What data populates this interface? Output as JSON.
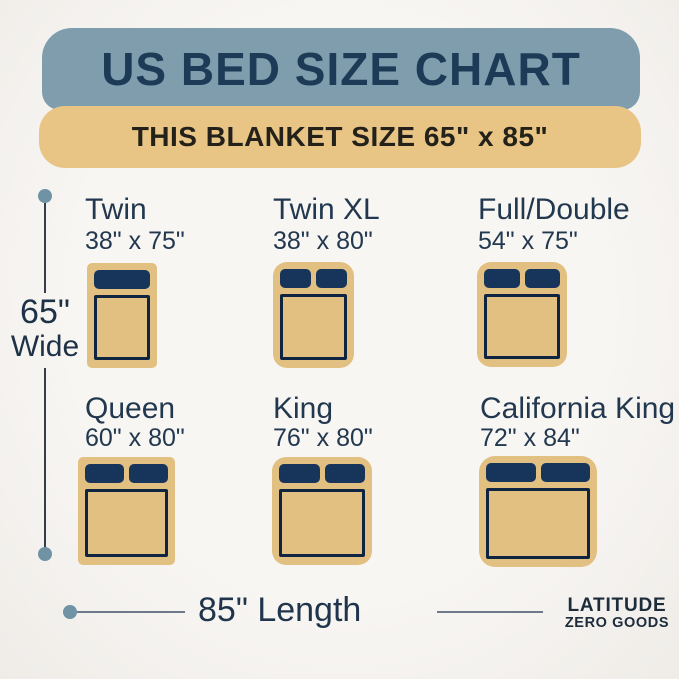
{
  "header": {
    "title": "US BED SIZE CHART",
    "subtitle": "THIS BLANKET SIZE 65\" x 85\""
  },
  "beds": [
    {
      "label": "Twin",
      "size": "38\" x 75\"",
      "pillows": 1
    },
    {
      "label": "Twin XL",
      "size": "38\" x 80\"",
      "pillows": 2
    },
    {
      "label": "Full/Double",
      "size": "54\" x 75\"",
      "pillows": 2
    },
    {
      "label": "Queen",
      "size": "60\" x 80\"",
      "pillows": 2
    },
    {
      "label": "King",
      "size": "76\" x 80\"",
      "pillows": 2
    },
    {
      "label": "California King",
      "size": "72\" x 84\"",
      "pillows": 2
    }
  ],
  "dimensions": {
    "width_value": "65\"",
    "width_label": "Wide",
    "length_label": "85\" Length"
  },
  "brand": {
    "line1": "LATITUDE",
    "line2": "ZERO GOODS"
  },
  "colors": {
    "background": "#f6f4f0",
    "header_blue": "#7f9dac",
    "header_tan": "#e8c585",
    "navy_text": "#1d3a56",
    "bed_tan": "#e2c082",
    "pillow_navy": "#17345b",
    "mattress_outline": "#0f2440",
    "dimension_dot": "#6f92a4"
  }
}
